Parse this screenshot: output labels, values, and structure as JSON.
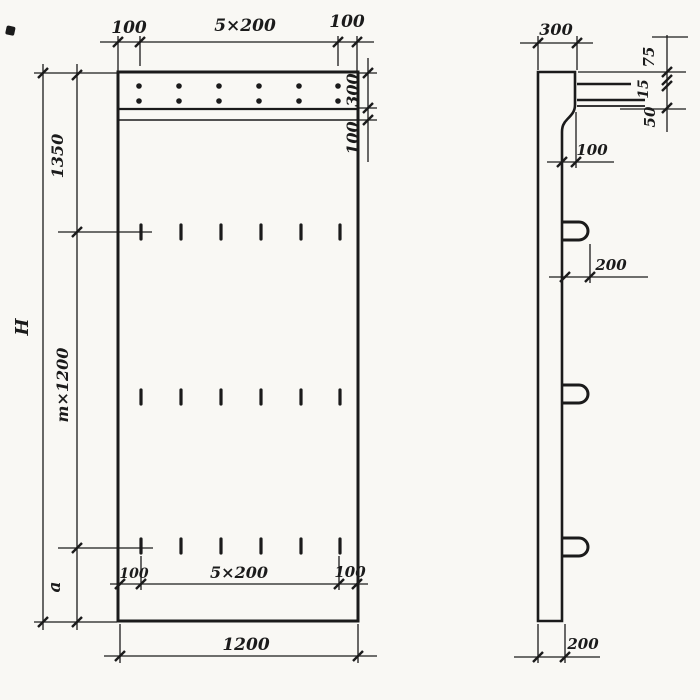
{
  "drawing": {
    "type": "reinforced-concrete-panel-working-drawing",
    "colors": {
      "ink": "#1b1b1b",
      "paper": "#f9f8f4"
    },
    "front": {
      "top": {
        "left": "100",
        "span": "5×200",
        "right": "100"
      },
      "right_chain": {
        "band": "300",
        "lip": "100"
      },
      "left_chain": {
        "overall": "H",
        "upper": "1350",
        "module": "m×1200",
        "lower": "a"
      },
      "bottom_inner": {
        "left": "100",
        "span": "5×200",
        "right": "100"
      },
      "overall_width": "1200"
    },
    "side": {
      "top_width": "300",
      "flange_chain": {
        "top": "75",
        "mid": "15",
        "bottom": "50"
      },
      "lip_offset": "100",
      "loop_offset": "200",
      "web_thickness": "200"
    }
  }
}
